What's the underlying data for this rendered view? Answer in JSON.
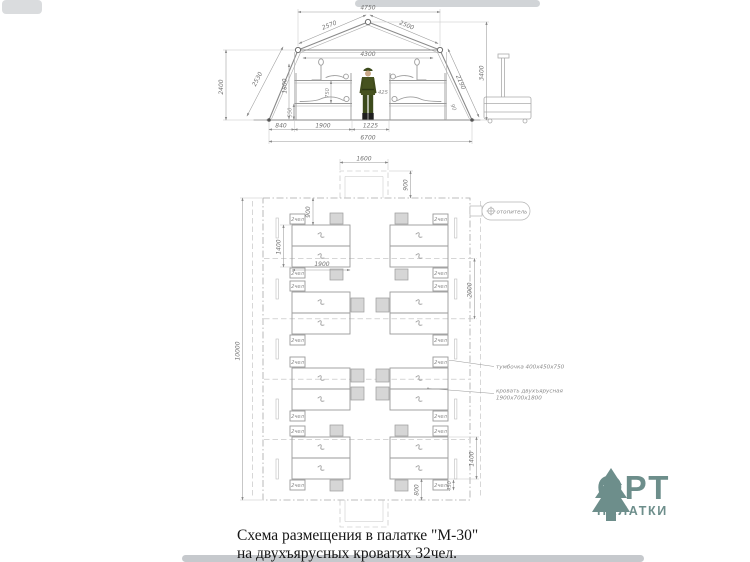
{
  "section": {
    "dims": {
      "ridge_width": "4750",
      "roof_left": "2570",
      "roof_right": "2500",
      "inner_width": "4300",
      "left_height": "2400",
      "left_slope": "2530",
      "wall_inner_height": "1800",
      "bunk_clearance": "750",
      "bunk_height": "550",
      "center_clearance": "425",
      "total_height": "3400",
      "right_slope": "2190",
      "skirt": "90",
      "base_side": "840",
      "bed_length": "1900",
      "aisle_width": "1225",
      "total_width": "6700"
    }
  },
  "plan": {
    "dims": {
      "tent_length": "10000",
      "entrance_width": "1600",
      "entrance_depth": "900",
      "head_gap": "900",
      "block_width": "1400",
      "block_length": "1900",
      "bay_spacing": "2000",
      "block_width_b": "1400",
      "nightstand_width": "450",
      "end_gap": "800"
    },
    "labels": {
      "heater": "отопитель",
      "nightstand": "тумбочка 400х450х750",
      "bed_line1": "кровать двухъярусная",
      "bed_line2": "1900х700х1800",
      "capacity": "2чел"
    }
  },
  "caption": {
    "line1": "Схема размещения в палатке \"М-30\"",
    "line2": "на двухъярусных кроватях 32чел."
  },
  "logo": {
    "title": "ОРТ",
    "subtitle": "ПАЛАТКИ",
    "color": "#6d8e8b"
  }
}
